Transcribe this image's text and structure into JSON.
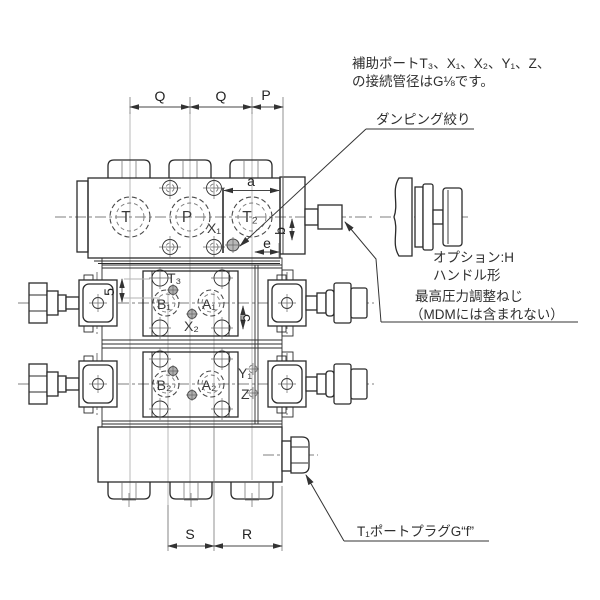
{
  "notes": {
    "aux_ports_line1": "補助ポートT₃、X₁、X₂、Y₁、Z、",
    "aux_ports_line2": "の接続管径はG⅛です。",
    "damping": "ダンピング絞り",
    "option_line1": "オプション:H",
    "option_line2": "ハンドル形",
    "pressure_line1": "最高圧力調整ねじ",
    "pressure_line2": "（MDMには含まれない）",
    "t1_plug": "T₁ポートプラグG“f”"
  },
  "dimensions": {
    "q": "Q",
    "p": "P",
    "a": "a",
    "b": "b",
    "e": "e",
    "offset": "5",
    "s": "S",
    "r": "R"
  },
  "ports": {
    "t": "T",
    "p": "P",
    "t2": "T₂",
    "x1": "X₁",
    "t3": "T₃",
    "b1": "B₁",
    "a1": "A₁",
    "x2": "X₂",
    "b2": "B₂",
    "a2": "A₂",
    "y1": "Y₁",
    "z": "Z"
  },
  "colors": {
    "line": "#2b2b2b",
    "dim": "#444444",
    "centerline": "#8a8a8a",
    "text": "#333333"
  }
}
